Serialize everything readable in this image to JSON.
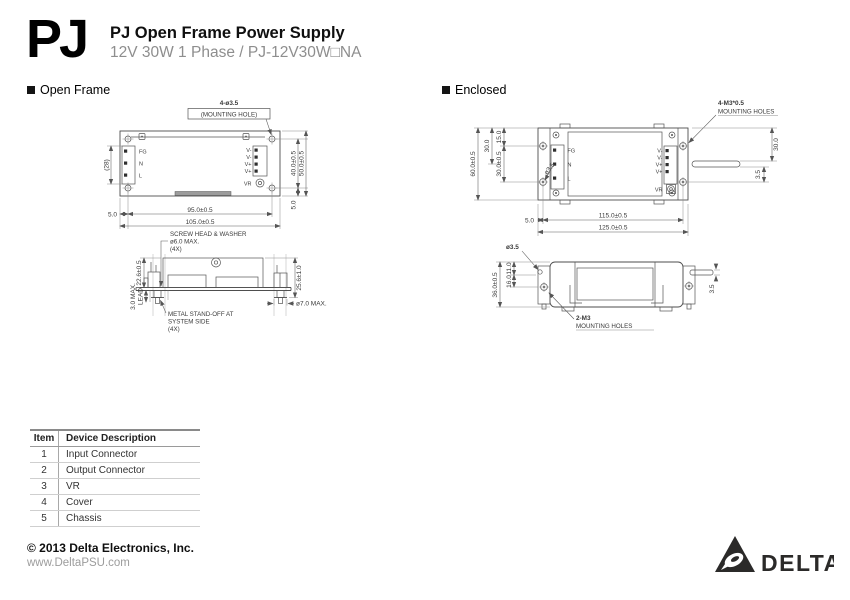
{
  "header": {
    "logo_text": "PJ",
    "title": "PJ Open Frame Power Supply",
    "subtitle": "12V 30W 1 Phase / PJ-12V30W□NA"
  },
  "open_frame": {
    "section_label": "Open Frame",
    "top_view": {
      "note_hole_count": "4-ø3.5",
      "note_hole_label": "(MOUNTING HOLE)",
      "pins_input": [
        "FG",
        "N",
        "L"
      ],
      "pins_output": [
        "V-",
        "V-",
        "V+",
        "V+",
        "VR"
      ],
      "dim_connector_width": "(28)",
      "dim_hole_span_v": "40.0±0.5",
      "dim_height": "50.0±0.5",
      "dim_edge_offset_v": "5.0",
      "dim_edge_offset_h": "5.0",
      "dim_hole_span_h": "95.0±0.5",
      "dim_width": "105.0±0.5"
    },
    "side_view": {
      "note_screw_1": "SCREW HEAD & WASHER",
      "note_screw_2": "ø6.0 MAX.",
      "note_screw_3": "(4X)",
      "dim_body_height": "22.6±0.5",
      "dim_total_height": "25.6±1.0",
      "dim_lead_max": "3.0 MAX.",
      "label_lead": "LEAD",
      "note_standoff_1": "METAL STAND-OFF AT",
      "note_standoff_2": "SYSTEM SIDE",
      "note_standoff_3": "(4X)",
      "dim_standoff_dia": "ø7.0 MAX."
    }
  },
  "enclosed": {
    "section_label": "Enclosed",
    "top_view": {
      "note_hole_count": "4-M3*0.5",
      "note_hole_label": "MOUNTING HOLES",
      "pins_input": [
        "FG",
        "N",
        "L"
      ],
      "pins_output": [
        "V-",
        "V-",
        "V+",
        "V+",
        "VR"
      ],
      "dim_height": "60.0±0.5",
      "dim_left_30": "30.0",
      "dim_hole_top": "15.0",
      "dim_hole_span_v": "30.0±0.5",
      "hole_dia": "ø3.5",
      "dim_right_30": "30.0",
      "dim_right_35": "3.5",
      "dim_edge_offset": "5.0",
      "dim_hole_span_h": "115.0±0.5",
      "dim_width": "125.0±0.5"
    },
    "side_view": {
      "hole_dia": "ø3.5",
      "dim_height": "36.0±0.5",
      "dim_11": "11.0",
      "dim_16": "16.0",
      "dim_tab": "3.5",
      "note_hole_count": "2-M3",
      "note_hole_label": "MOUNTING HOLES"
    }
  },
  "device_table": {
    "headers": [
      "Item",
      "Device Description"
    ],
    "rows": [
      {
        "item": "1",
        "description": "Input Connector"
      },
      {
        "item": "2",
        "description": "Output Connector"
      },
      {
        "item": "3",
        "description": "VR"
      },
      {
        "item": "4",
        "description": "Cover"
      },
      {
        "item": "5",
        "description": "Chassis"
      }
    ]
  },
  "footer": {
    "copyright": "© 2013 Delta Electronics, Inc.",
    "website": "www.DeltaPSU.com",
    "brand": "DELTA"
  }
}
